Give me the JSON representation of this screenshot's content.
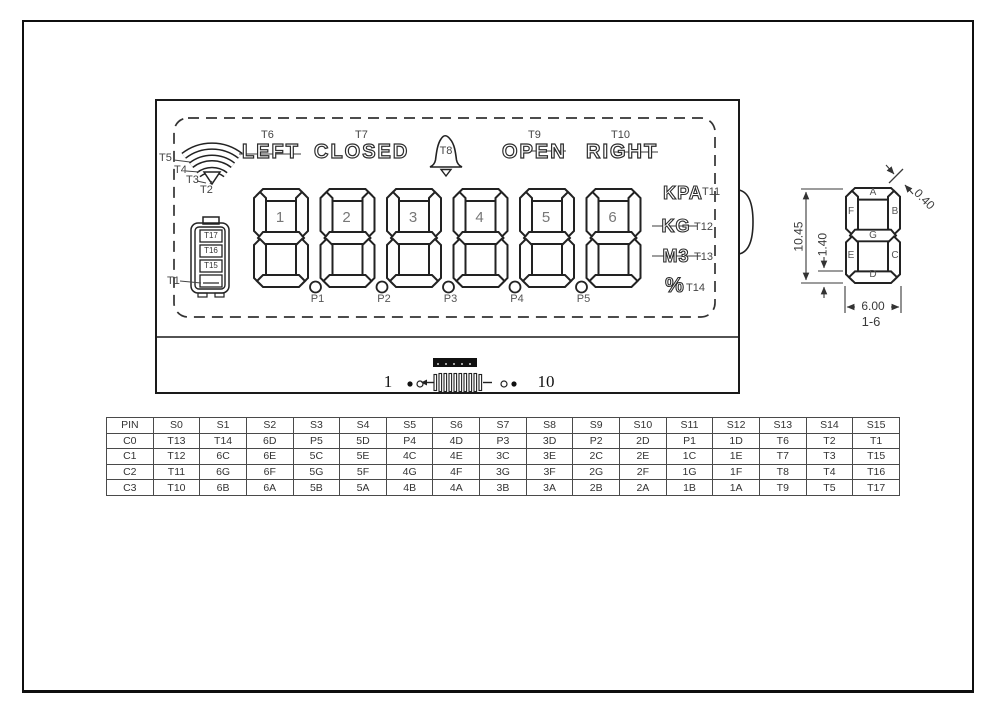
{
  "module": {
    "wifi": {
      "tags": [
        "T5",
        "T4",
        "T3",
        "T2"
      ]
    },
    "status_row": [
      {
        "label": "LEFT",
        "tag": "T6"
      },
      {
        "label": "CLOSED",
        "tag": "T7"
      },
      {
        "label": "OPEN",
        "tag": "T9"
      },
      {
        "label": "RIGHT",
        "tag": "T10"
      }
    ],
    "bell_tag": "T8",
    "battery": {
      "bar_tags": [
        "T17",
        "T16",
        "T15"
      ],
      "case_tag": "T1"
    },
    "digit_numbers": [
      "1",
      "2",
      "3",
      "4",
      "5",
      "6"
    ],
    "point_tags": [
      "P1",
      "P2",
      "P3",
      "P4",
      "P5"
    ],
    "units": [
      {
        "label": "KPA",
        "tag": "T11"
      },
      {
        "label": "KG",
        "tag": "T12"
      },
      {
        "label": "M3",
        "tag": "T13"
      },
      {
        "label": "%",
        "tag": "T14"
      }
    ],
    "connector": {
      "pin_first": "1",
      "pin_last": "10"
    }
  },
  "detail": {
    "segment_labels": [
      "A",
      "F",
      "B",
      "G",
      "E",
      "C",
      "D"
    ],
    "dimensions": {
      "height": "10.45",
      "segment_width": "1.40",
      "width": "6.00",
      "gap": "0.40",
      "applies_to": "1-6"
    }
  },
  "pin_table": {
    "headers": [
      "PIN",
      "S0",
      "S1",
      "S2",
      "S3",
      "S4",
      "S5",
      "S6",
      "S7",
      "S8",
      "S9",
      "S10",
      "S11",
      "S12",
      "S13",
      "S14",
      "S15"
    ],
    "rows": [
      [
        "C0",
        "T13",
        "T14",
        "6D",
        "P5",
        "5D",
        "P4",
        "4D",
        "P3",
        "3D",
        "P2",
        "2D",
        "P1",
        "1D",
        "T6",
        "T2",
        "T1"
      ],
      [
        "C1",
        "T12",
        "6C",
        "6E",
        "5C",
        "5E",
        "4C",
        "4E",
        "3C",
        "3E",
        "2C",
        "2E",
        "1C",
        "1E",
        "T7",
        "T3",
        "T15"
      ],
      [
        "C2",
        "T11",
        "6G",
        "6F",
        "5G",
        "5F",
        "4G",
        "4F",
        "3G",
        "3F",
        "2G",
        "2F",
        "1G",
        "1F",
        "T8",
        "T4",
        "T16"
      ],
      [
        "C3",
        "T10",
        "6B",
        "6A",
        "5B",
        "5A",
        "4B",
        "4A",
        "3B",
        "3A",
        "2B",
        "2A",
        "1B",
        "1A",
        "T9",
        "T5",
        "T17"
      ]
    ]
  }
}
